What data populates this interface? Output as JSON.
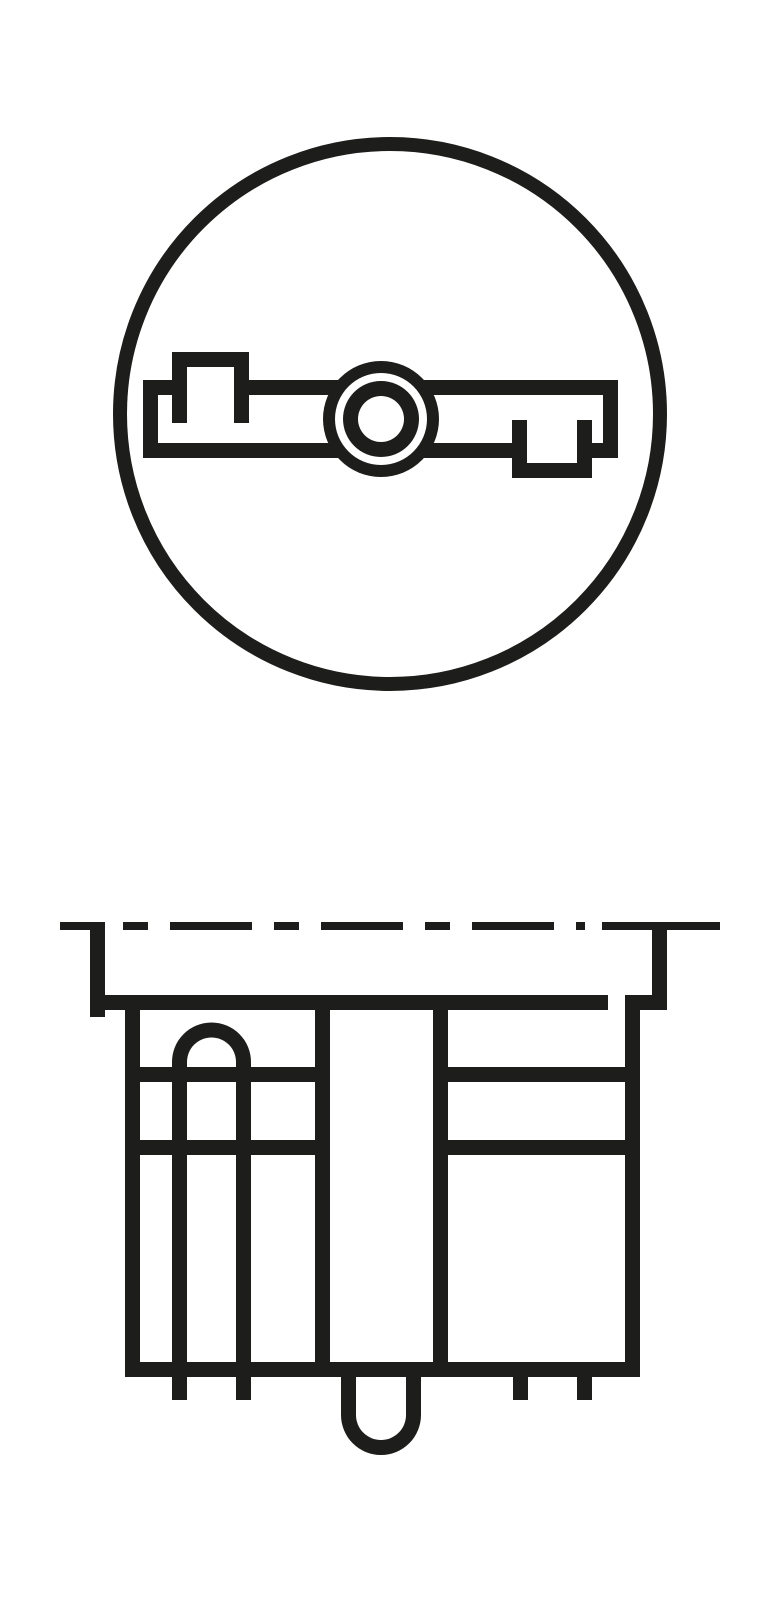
{
  "colors": {
    "ink": "#1d1d1b",
    "background": "#ffffff"
  },
  "icons": {
    "top_view": "wedge-base-bulb-top-view-icon",
    "front_view": "wedge-base-bulb-front-view-icon"
  }
}
